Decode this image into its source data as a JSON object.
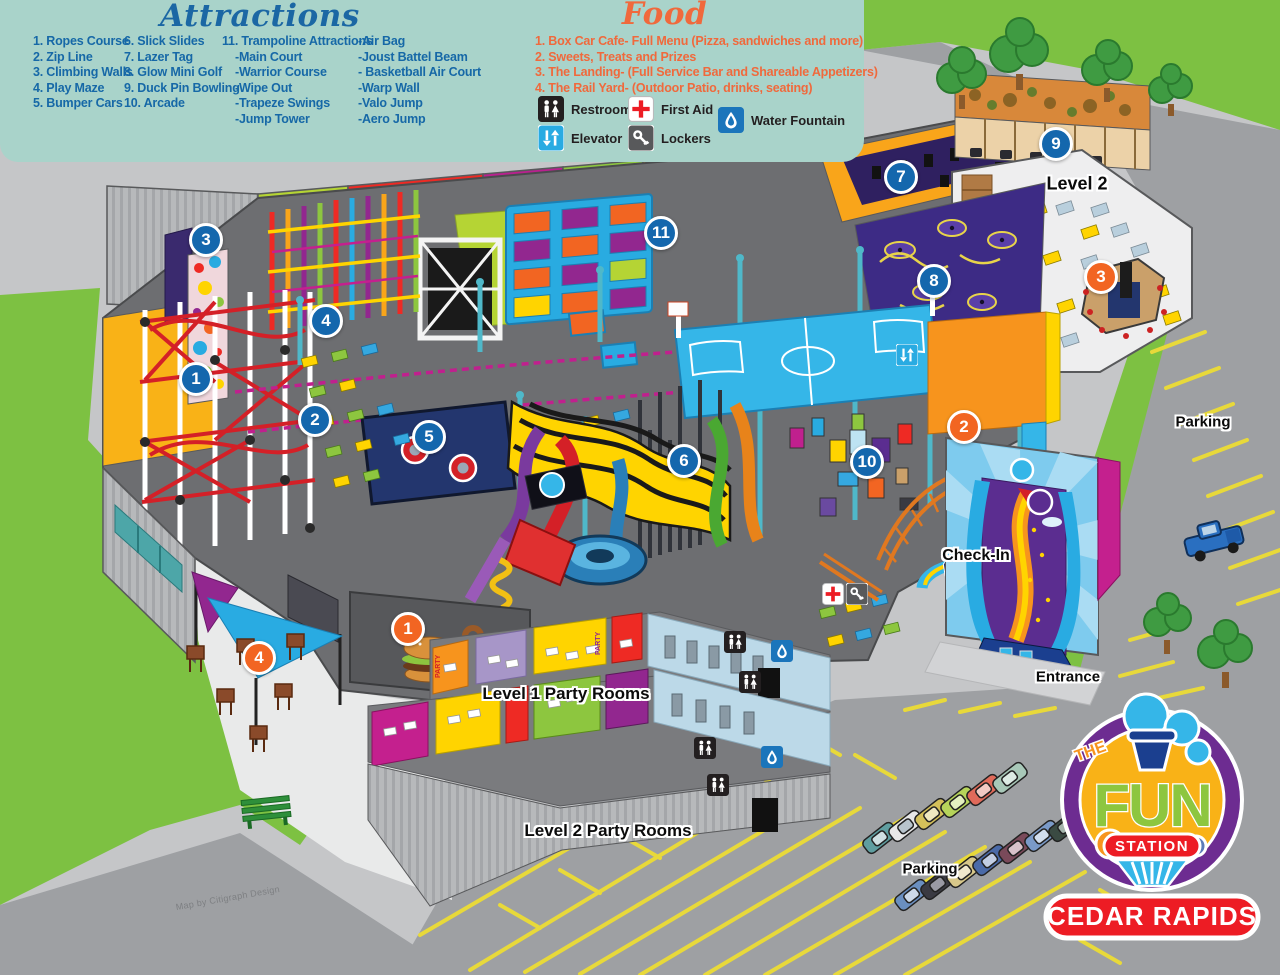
{
  "legend": {
    "attractions": {
      "title": "Attractions",
      "columns": [
        [
          "1. Ropes Course",
          "2. Zip Line",
          "3. Climbing Walls",
          "4. Play Maze",
          "5. Bumper Cars"
        ],
        [
          "6. Slick Slides",
          "7. Lazer Tag",
          "8. Glow Mini Golf",
          "9. Duck Pin Bowling",
          "10. Arcade"
        ],
        [
          "11. Trampoline Attractions",
          "-Main Court",
          "-Warrior Course",
          "-Wipe Out",
          "-Trapeze Swings",
          "-Jump Tower"
        ],
        [
          "-Air Bag",
          "-Joust Battel Beam",
          "- Basketball Air Court",
          "-Warp Wall",
          "-Valo Jump",
          "-Aero Jump"
        ]
      ]
    },
    "food": {
      "title": "Food",
      "items": [
        "1. Box Car Cafe- Full Menu (Pizza, sandwiches and more)",
        "2. Sweets, Treats and Prizes",
        "3. The Landing- (Full Service Bar and Shareable Appetizers)",
        "4. The Rail Yard- (Outdoor Patio, drinks, seating)"
      ]
    },
    "key": [
      {
        "icon": "restrooms",
        "label": "Restrooms",
        "x": 538,
        "y": 96
      },
      {
        "icon": "first-aid",
        "label": "First Aid",
        "x": 628,
        "y": 96
      },
      {
        "icon": "water-fountain",
        "label": "Water Fountain",
        "x": 718,
        "y": 107
      },
      {
        "icon": "elevator",
        "label": "Elevator",
        "x": 538,
        "y": 125
      },
      {
        "icon": "lockers",
        "label": "Lockers",
        "x": 628,
        "y": 125
      }
    ]
  },
  "map": {
    "party_label": "PARTY",
    "credit": "Map by Citigraph Design",
    "markers": [
      {
        "type": "attraction",
        "n": "1",
        "x": 196,
        "y": 379,
        "title": "Ropes Course"
      },
      {
        "type": "attraction",
        "n": "2",
        "x": 315,
        "y": 420,
        "title": "Zip Line"
      },
      {
        "type": "attraction",
        "n": "3",
        "x": 206,
        "y": 240,
        "title": "Climbing Walls"
      },
      {
        "type": "attraction",
        "n": "4",
        "x": 326,
        "y": 321,
        "title": "Play Maze"
      },
      {
        "type": "attraction",
        "n": "5",
        "x": 429,
        "y": 437,
        "title": "Bumper Cars"
      },
      {
        "type": "attraction",
        "n": "6",
        "x": 684,
        "y": 461,
        "title": "Slick Slides"
      },
      {
        "type": "attraction",
        "n": "7",
        "x": 901,
        "y": 177,
        "title": "Lazer Tag"
      },
      {
        "type": "attraction",
        "n": "8",
        "x": 934,
        "y": 281,
        "title": "Glow Mini Golf"
      },
      {
        "type": "attraction",
        "n": "9",
        "x": 1056,
        "y": 144,
        "title": "Duck Pin Bowling"
      },
      {
        "type": "attraction",
        "n": "10",
        "x": 867,
        "y": 462,
        "title": "Arcade"
      },
      {
        "type": "attraction",
        "n": "11",
        "x": 661,
        "y": 233,
        "title": "Trampoline Attractions"
      },
      {
        "type": "food",
        "n": "1",
        "x": 408,
        "y": 629,
        "title": "Box Car Cafe"
      },
      {
        "type": "food",
        "n": "2",
        "x": 964,
        "y": 427,
        "title": "Sweets, Treats and Prizes"
      },
      {
        "type": "food",
        "n": "3",
        "x": 1101,
        "y": 277,
        "title": "The Landing"
      },
      {
        "type": "food",
        "n": "4",
        "x": 259,
        "y": 658,
        "title": "The Rail Yard"
      }
    ],
    "labels": [
      {
        "text": "Level 2",
        "x": 1077,
        "y": 184,
        "size": 18
      },
      {
        "text": "Parking",
        "x": 1203,
        "y": 422,
        "size": 15
      },
      {
        "text": "Check-In",
        "x": 976,
        "y": 556,
        "size": 16
      },
      {
        "text": "Entrance",
        "x": 1068,
        "y": 677,
        "size": 15
      },
      {
        "text": "Level 1 Party Rooms",
        "x": 566,
        "y": 694,
        "size": 17
      },
      {
        "text": "Level 2 Party Rooms",
        "x": 608,
        "y": 831,
        "size": 17
      },
      {
        "text": "Parking",
        "x": 930,
        "y": 869,
        "size": 15
      }
    ],
    "facility_icons": [
      {
        "icon": "elevator",
        "x": 907,
        "y": 355
      },
      {
        "icon": "first-aid",
        "x": 833,
        "y": 594
      },
      {
        "icon": "lockers",
        "x": 857,
        "y": 594
      },
      {
        "icon": "restrooms",
        "x": 735,
        "y": 642
      },
      {
        "icon": "restrooms",
        "x": 750,
        "y": 682
      },
      {
        "icon": "restrooms",
        "x": 705,
        "y": 748
      },
      {
        "icon": "restrooms",
        "x": 718,
        "y": 785
      },
      {
        "icon": "water-fountain",
        "x": 782,
        "y": 651
      },
      {
        "icon": "water-fountain",
        "x": 772,
        "y": 757
      }
    ]
  },
  "logo": {
    "prefix": "THE",
    "name": "FUN",
    "suffix": "STATION",
    "location": "CEDAR RAPIDS"
  },
  "colors": {
    "attraction_marker": "#1467ad",
    "food_marker": "#f26522",
    "legend_bg": "#a9d3ca",
    "attractions_text": "#1668a7",
    "food_text": "#f0693c",
    "grass": "#7dc142",
    "pavement": "#9ea0a3",
    "floor": "#6d6e71"
  }
}
